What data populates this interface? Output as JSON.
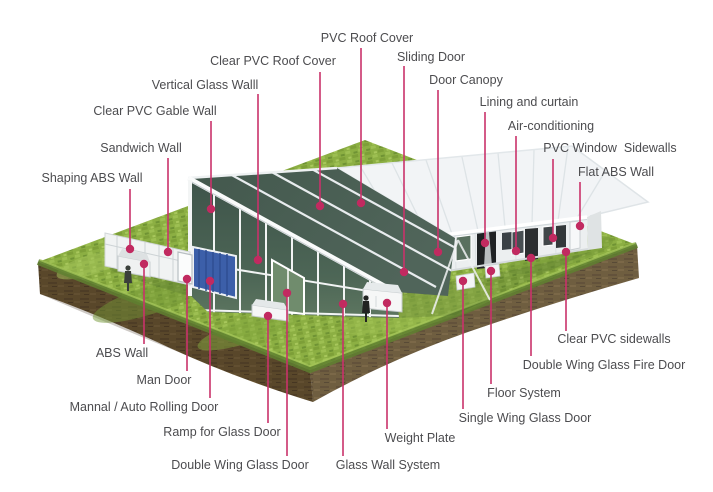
{
  "colors": {
    "accent_line": "#c9326b",
    "accent_dot": "#c12a60",
    "label_text": "#4c4c4f",
    "grass_green": "#8caf43",
    "dirt_brown": "#63502f",
    "clear_pvc_green": "#465b50",
    "roof_white": "#f2f4f6",
    "rolling_door_blue": "#3c5fa9"
  },
  "labels": [
    {
      "id": "pvc-roof-cover",
      "text": "PVC Roof Cover"
    },
    {
      "id": "clear-pvc-roof-cover",
      "text": "Clear PVC Roof Cover"
    },
    {
      "id": "sliding-door",
      "text": "Sliding Door"
    },
    {
      "id": "vertical-glass-walll",
      "text": "Vertical Glass Walll"
    },
    {
      "id": "door-canopy",
      "text": "Door Canopy"
    },
    {
      "id": "clear-pvc-gable-wall",
      "text": "Clear PVC Gable Wall"
    },
    {
      "id": "lining-and-curtain",
      "text": "Lining and curtain"
    },
    {
      "id": "sandwich-wall",
      "text": "Sandwich Wall"
    },
    {
      "id": "air-conditioning",
      "text": "Air-conditioning"
    },
    {
      "id": "shaping-abs-wall",
      "text": "Shaping ABS Wall"
    },
    {
      "id": "pvc-window-sidewalls",
      "text": "PVC Window  Sidewalls"
    },
    {
      "id": "flat-abs-wall",
      "text": "Flat ABS Wall"
    },
    {
      "id": "abs-wall",
      "text": "ABS Wall"
    },
    {
      "id": "man-door",
      "text": "Man Door"
    },
    {
      "id": "mannal-auto-rolling-door",
      "text": "Mannal / Auto Rolling Door"
    },
    {
      "id": "ramp-for-glass-door",
      "text": "Ramp for Glass Door"
    },
    {
      "id": "double-wing-glass-door",
      "text": "Double Wing Glass Door"
    },
    {
      "id": "glass-wall-system",
      "text": "Glass Wall System"
    },
    {
      "id": "weight-plate",
      "text": "Weight Plate"
    },
    {
      "id": "single-wing-glass-door",
      "text": "Single Wing Glass Door"
    },
    {
      "id": "floor-system",
      "text": "Floor System"
    },
    {
      "id": "double-wing-glass-fire-door",
      "text": "Double Wing Glass Fire Door"
    },
    {
      "id": "clear-pvc-sidewalls",
      "text": "Clear PVC sidewalls"
    }
  ]
}
